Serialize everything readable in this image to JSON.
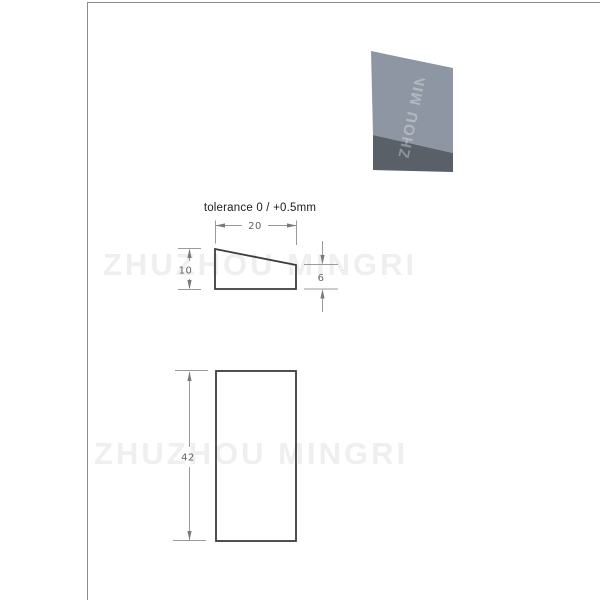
{
  "watermark": {
    "text": "ZHUZHOU MINGRI",
    "color": "#efefef"
  },
  "drawing": {
    "tolerance_note": "tolerance 0 / +0.5mm",
    "top_view": {
      "shape": "wedge-cross-section",
      "width_label": "20",
      "left_height_label": "10",
      "right_height_label": "6"
    },
    "front_view": {
      "shape": "rectangle",
      "height_label": "42"
    },
    "colors": {
      "outline": "#3d3d3d",
      "dimension_lines": "#9a9a9a",
      "dimension_text": "#636363",
      "note_text": "#1c1c1c"
    }
  },
  "photo": {
    "watermark_text": "ZHUZHOU MINGRI",
    "top_face_color": "#8e96a3",
    "shadow_face_color": "#596068"
  }
}
